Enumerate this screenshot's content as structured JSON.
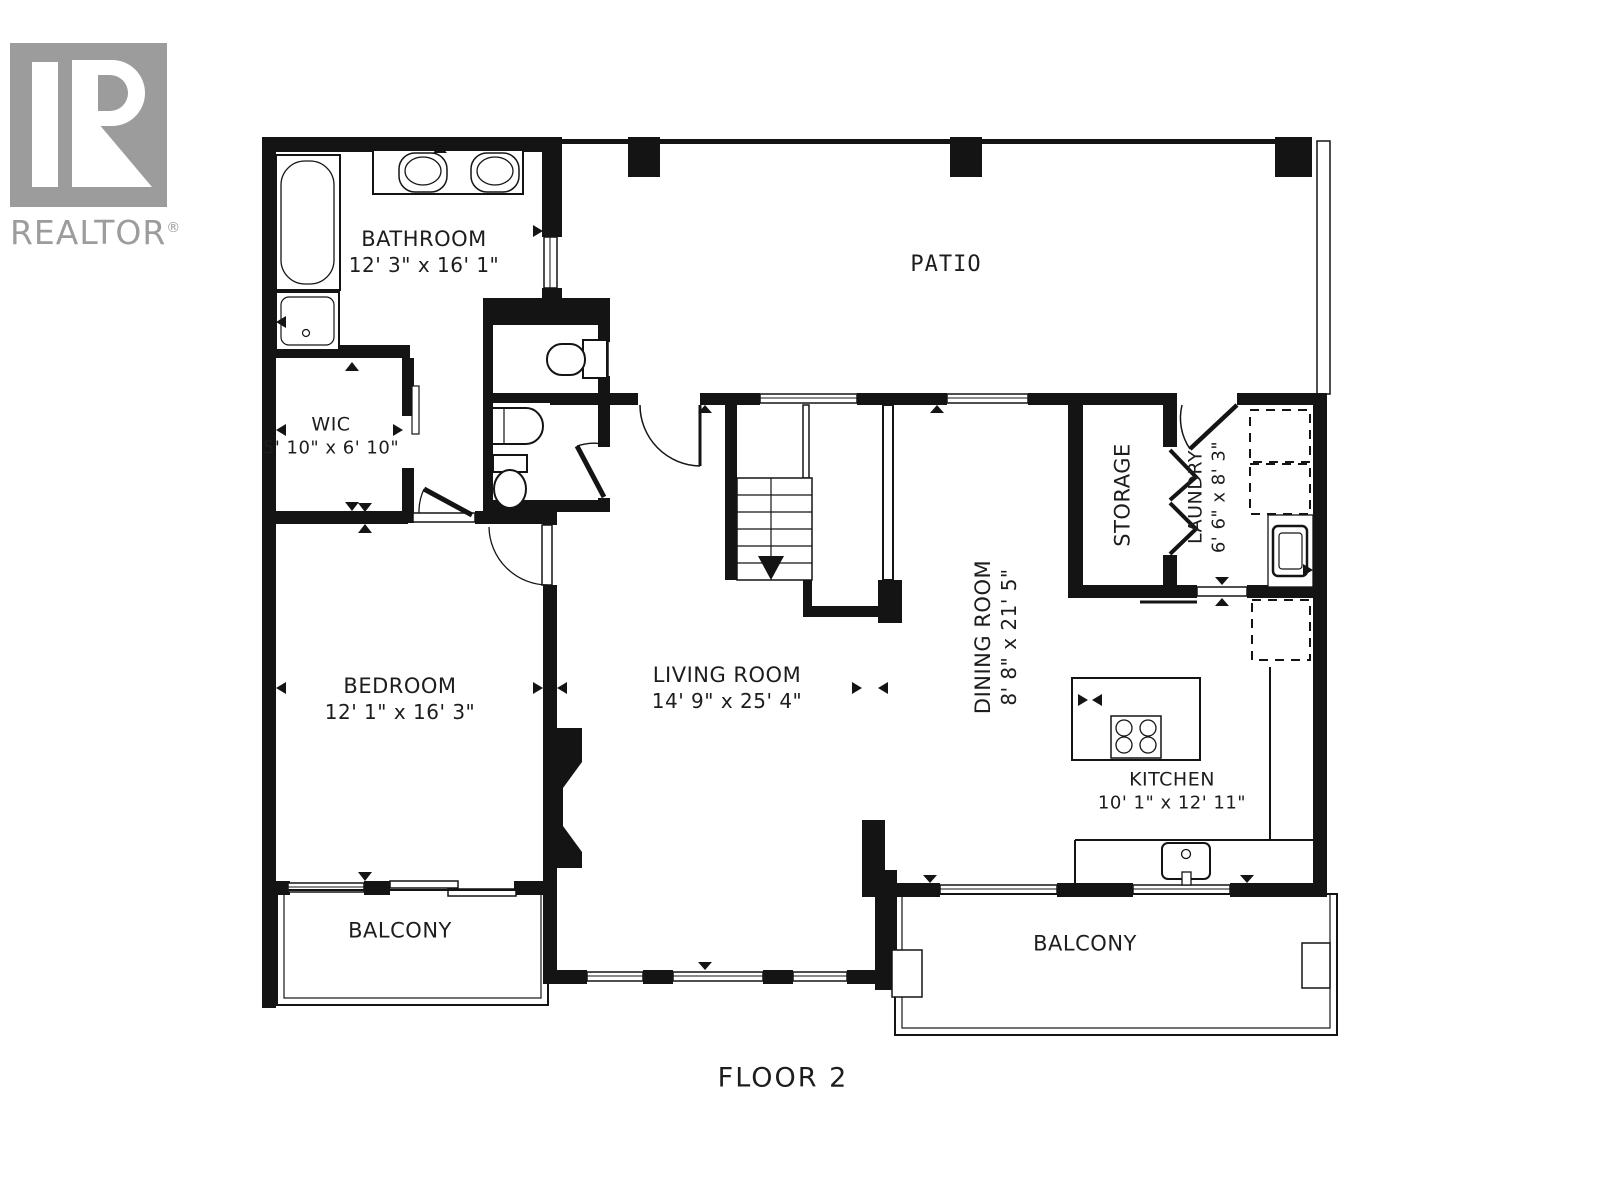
{
  "logo": {
    "letter": "R",
    "brand": "REALTOR",
    "registered": "®"
  },
  "plan": {
    "floor_label": "FLOOR 2"
  },
  "rooms": {
    "bathroom": {
      "name": "BATHROOM",
      "dims": "12' 3\" x 16' 1\""
    },
    "patio": {
      "name": "PATIO"
    },
    "wic": {
      "name": "WIC",
      "dims": "5' 10\" x 6' 10\""
    },
    "bedroom": {
      "name": "BEDROOM",
      "dims": "12' 1\" x 16' 3\""
    },
    "living_room": {
      "name": "LIVING ROOM",
      "dims": "14' 9\" x 25' 4\""
    },
    "dining_room": {
      "name": "DINING ROOM",
      "dims": "8' 8\" x 21' 5\""
    },
    "storage": {
      "name": "STORAGE"
    },
    "laundry": {
      "name": "LAUNDRY",
      "dims": "6' 6\" x 8' 3\""
    },
    "kitchen": {
      "name": "KITCHEN",
      "dims": "10' 1\" x 12' 11\""
    },
    "balcony_left": {
      "name": "BALCONY"
    },
    "balcony_right": {
      "name": "BALCONY"
    }
  },
  "colors": {
    "wall": "#141414",
    "background": "#ffffff",
    "logo_gray": "#9c9c9c",
    "text": "#1d1d1d"
  }
}
